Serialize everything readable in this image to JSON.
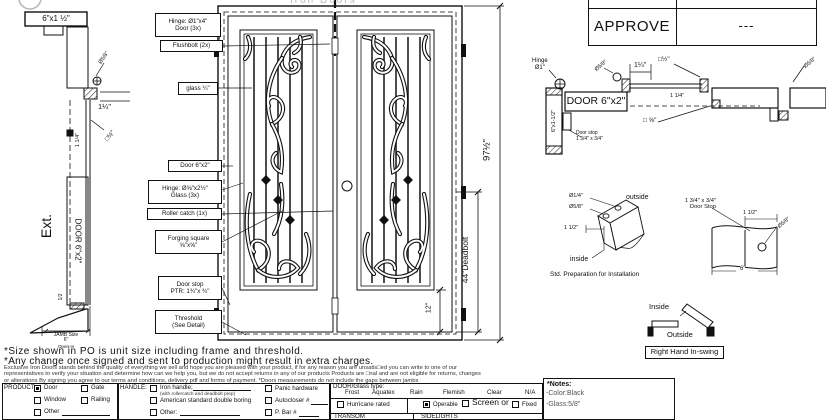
{
  "brand": {
    "name_faint": "Iron Doors"
  },
  "approval": {
    "label": "APPROVE",
    "value": "---"
  },
  "section_left": {
    "header": "6\"x1 ½\"",
    "dia58": "Ø5/8\"",
    "dim114": "1¼\"",
    "dim114_vert": "1 1/4\"",
    "sq12": "□½\"",
    "ext": "Ext.",
    "door": "DOOR 6\"x2\"",
    "half": "1/2",
    "jamb1": "JAMB Size",
    "jamb2": "6\"",
    "open_in": "Open In"
  },
  "callouts": [
    {
      "text": "Hinge: Ø1\"x4\"\nDoor (3x)"
    },
    {
      "text": "Flushbolt (2x)"
    },
    {
      "text": "glass ¼\""
    },
    {
      "text": "Door  6\"x2\""
    },
    {
      "text": "Hinge: Ø⅝\"x2½\"\nGlass (3x)"
    },
    {
      "text": "Roller catch  (1x)"
    },
    {
      "text": "Forging square\n⅝\"x⅝\""
    },
    {
      "text": "Door stop\nPTR: 1¾\"x ¾\""
    },
    {
      "text": "Threshold\n(See Detail)"
    }
  ],
  "elevation": {
    "height": "97½\"",
    "deadbolt": "44\"Deadbolt",
    "bottom": "12\""
  },
  "plan": {
    "hinge": "Hinge\nØ1\"",
    "dia58_left": "Ø5/8\"",
    "dim114_top": "1¼\"",
    "sq12": "□½\"",
    "dia58_right": "Ø5/8\"",
    "door": "DOOR 6\"x2\"",
    "jamb": "6\"x1-1/2\"",
    "doorstop": "Door stop\n1 3/4\" x 3/4\"",
    "dim114": "1 1/4\"",
    "sq58": "□ ⅝\""
  },
  "prep": {
    "outside": "outside",
    "dia14": "Ø1/4\"",
    "dia58": "Ø5/8\"",
    "dim112": "1 1/2\"",
    "inside": "inside",
    "caption": "Std. Preparation for Installation"
  },
  "stop_detail": {
    "label": "1 3/4\" x 3/4\"\nDoor Stop",
    "dim112": "1 1/2\"",
    "dia58": "Ø5/8\"",
    "width": "6\""
  },
  "swing": {
    "inside": "Inside",
    "outside": "Outside",
    "label": "Right Hand In-swing"
  },
  "notes": {
    "line1": "*Size shown in PO is unit size including frame and threshold.",
    "line2": "*Any change once signed and sent to production might result in extra charges."
  },
  "fine_print": {
    "l1": "Exclusive Iron Doors stands behind the quality of everything we sell and hope you are pleased with your product, if for any reason you are unsatis□ed you can write to one of our",
    "l2": "representatives to verify your situation and determine how can we help you, but we do not accept returns in any of our products Products are □nal and are not eligible for returns, changes",
    "l3": "or alterations By signing you agree to our terms and conditions, delivery pdf and forms of payment. *Doors measurements do not include the gaps between jambs"
  },
  "form": {
    "product": {
      "label": "PRODUCT:",
      "door": "Door",
      "gate": "Gate",
      "window": "Window",
      "railing": "Railing",
      "other": "Other",
      "checked": "Door"
    },
    "handle": {
      "label": "HANDLE:",
      "iron": "Iron handle;",
      "iron_note": "(with rollercatch and deadbolt prep)",
      "american": "American standard double boring",
      "other": "Other:",
      "panic": "Panic hardware",
      "autocloser": "Autocloser #",
      "pbar": "P. Bar #"
    },
    "glass": {
      "label": "DOOR/Glass type:",
      "t1": "Frost",
      "t2": "Aquatex",
      "t3": "Rain",
      "t4": "Flemish",
      "t5": "Clear",
      "t6": "N/A",
      "hurricane": "Hurricane rated",
      "operable": "Operable",
      "screen": "Screen or",
      "fixed": "Fixed",
      "checked": "Operable",
      "transom": "TRANSOM",
      "sidelights": "SIDELIGHTS"
    },
    "notes": {
      "title": "*Notes:",
      "color": "-Color:Black",
      "glass": "-Glass:5/8\""
    }
  }
}
